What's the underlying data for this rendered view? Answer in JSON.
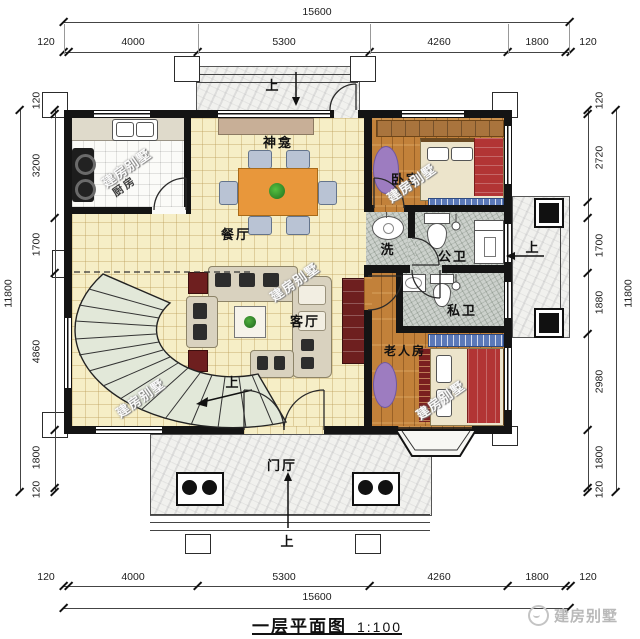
{
  "title": {
    "name": "一层平面图",
    "scale": "1:100"
  },
  "brand": "建房别墅",
  "watermark": "建房别墅",
  "labels": {
    "kitchen": "厨房",
    "dining": "餐厅",
    "shrine": "神龛",
    "living": "客厅",
    "bedroom": "卧室",
    "wash": "洗",
    "public_bath": "公卫",
    "private_bath": "私卫",
    "elder_room": "老人房",
    "foyer": "门厅",
    "up": "上"
  },
  "dimensions": {
    "top": {
      "total": "15600",
      "segments": [
        "120",
        "4000",
        "5300",
        "4260",
        "1800",
        "120"
      ]
    },
    "bottom": {
      "total": "15600",
      "segments": [
        "120",
        "4000",
        "5300",
        "4260",
        "1800",
        "120"
      ]
    },
    "left": {
      "total": "11800",
      "segments": [
        "120",
        "3200",
        "1700",
        "4860",
        "1800",
        "120"
      ]
    },
    "right": {
      "total": "11800",
      "segments": [
        "120",
        "2720",
        "1700",
        "1880",
        "2980",
        "1800",
        "120"
      ]
    }
  },
  "colors": {
    "wall": "#141414",
    "tile_floor": "#f6eec6",
    "wood_floor": "#c2813a",
    "bath_floor": "#ccd1cc",
    "dining_table": "#e8973b",
    "sofa": "#d9d2bf",
    "bed_blanket": "#b23535",
    "bench_blue": "#5b79b9",
    "rug_purple": "#9d7cc0"
  }
}
